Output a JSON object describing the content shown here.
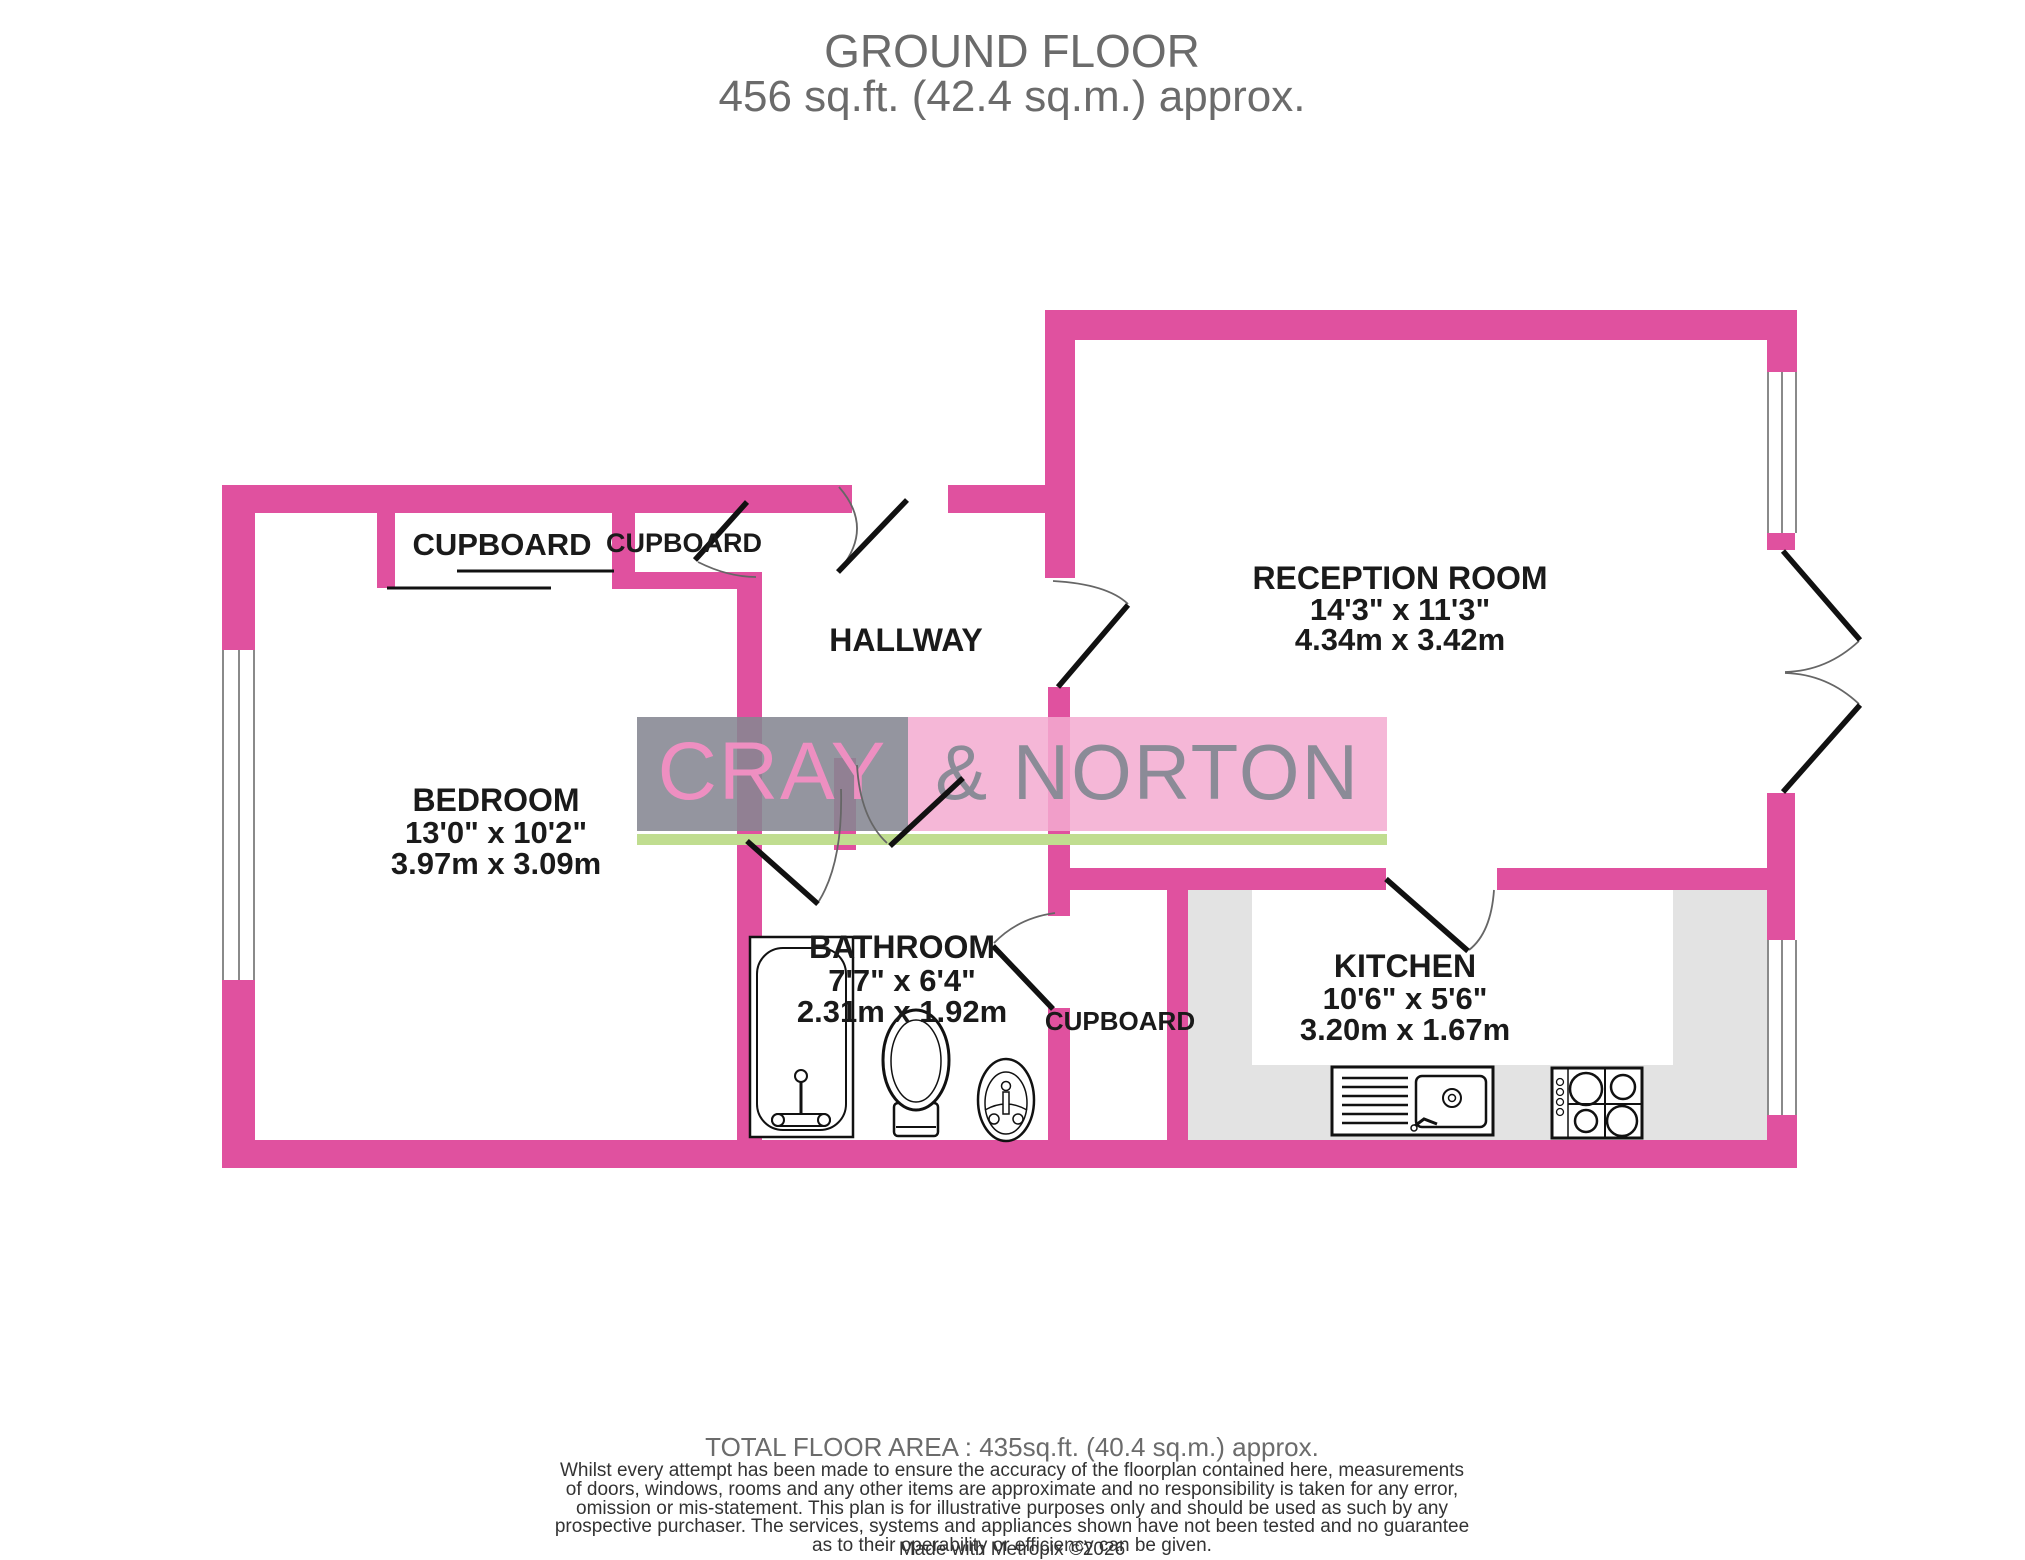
{
  "title": {
    "line1": "GROUND FLOOR",
    "line2": "456 sq.ft. (42.4 sq.m.) approx."
  },
  "watermark": {
    "left": "CRAY",
    "right": "& NORTON"
  },
  "rooms": {
    "reception": {
      "name": "RECEPTION ROOM",
      "imperial": "14'3\"  x 11'3\"",
      "metric": "4.34m  x 3.42m"
    },
    "bedroom": {
      "name": "BEDROOM",
      "imperial": "13'0\"  x 10'2\"",
      "metric": "3.97m  x 3.09m"
    },
    "bathroom": {
      "name": "BATHROOM",
      "imperial": "7'7\"  x 6'4\"",
      "metric": "2.31m  x 1.92m"
    },
    "kitchen": {
      "name": "KITCHEN",
      "imperial": "10'6\"  x 5'6\"",
      "metric": "3.20m  x 1.67m"
    },
    "hallway": {
      "name": "HALLWAY"
    },
    "cupboard_top_left": {
      "name": "CUPBOARD"
    },
    "cupboard_top_right": {
      "name": "CUPBOARD"
    },
    "cupboard_lower": {
      "name": "CUPBOARD"
    }
  },
  "footer": {
    "total": "TOTAL FLOOR AREA : 435sq.ft. (40.4 sq.m.) approx.",
    "disclaimer": "Whilst every attempt has been made to ensure the accuracy of the floorplan contained here, measurements\nof doors, windows, rooms and any other items are approximate and no responsibility is taken for any error,\nomission or mis-statement. This plan is for illustrative purposes only and should be used as such by any\nprospective purchaser. The services, systems and appliances shown have not been tested and no guarantee\nas to their operability or efficiency can be given.",
    "credit": "Made with Metropix ©2026"
  },
  "colors": {
    "wall_pink": "#e0519f",
    "watermark_gray": "#85868e",
    "watermark_pink": "#f3abd1",
    "watermark_letters_pink": "#ee8fc1",
    "watermark_letters_gray": "#8b8b97",
    "green_bar": "#c0dd90",
    "counter_gray": "#e3e3e3",
    "title_gray": "#6b6b6b",
    "label_text": "#1a1a1a"
  }
}
